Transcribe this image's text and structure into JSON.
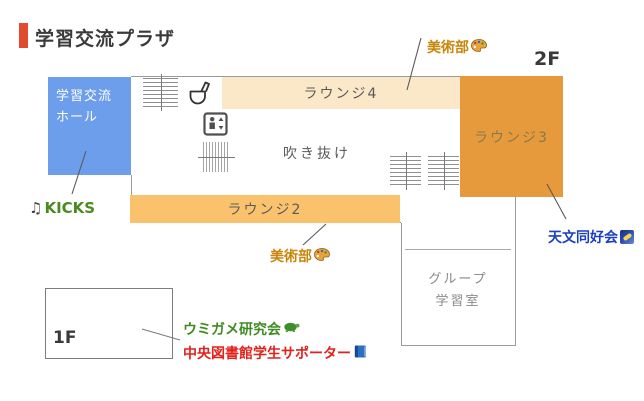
{
  "header": {
    "title": "学習交流プラザ",
    "floor_2f": "2F",
    "accent_color": "#E04A2F"
  },
  "map": {
    "hall": {
      "line1": "学習交流",
      "line2": "ホール",
      "color": "#6D9EEB"
    },
    "lounge4": {
      "name": "ラウンジ4",
      "color": "#FAE8C9"
    },
    "lounge3": {
      "name": "ラウンジ3",
      "color": "#E79A3C"
    },
    "lounge2": {
      "name": "ラウンジ2",
      "color": "#FBC26E"
    },
    "atrium": {
      "name": "吹き抜け"
    },
    "group_room": {
      "line1": "グループ",
      "line2": "学習室"
    },
    "floor_1f": "1F",
    "facility_icons": [
      "stairs-icon",
      "toilet-icon",
      "elevator-icon",
      "stairs-icon",
      "stairs-icon",
      "stairs-icon"
    ]
  },
  "labels": {
    "art_club_top": {
      "text": "美術部",
      "icon": "palette-icon",
      "color": "#C8860B"
    },
    "kicks": {
      "note_char": "♫",
      "text": "KICKS",
      "icon": "music-notes-icon",
      "color": "#4A8B1F"
    },
    "astronomy": {
      "text": "天文同好会",
      "icon": "milky-way-icon",
      "color": "#1A3FC1"
    },
    "art_club_bottom": {
      "text": "美術部",
      "icon": "palette-icon",
      "color": "#C8860B"
    },
    "sea_turtle": {
      "text": "ウミガメ研究会",
      "icon": "turtle-icon",
      "color": "#3F8C22"
    },
    "library_supporter": {
      "text": "中央図書館学生サポーター",
      "icon": "book-icon",
      "color": "#E3201B"
    }
  }
}
